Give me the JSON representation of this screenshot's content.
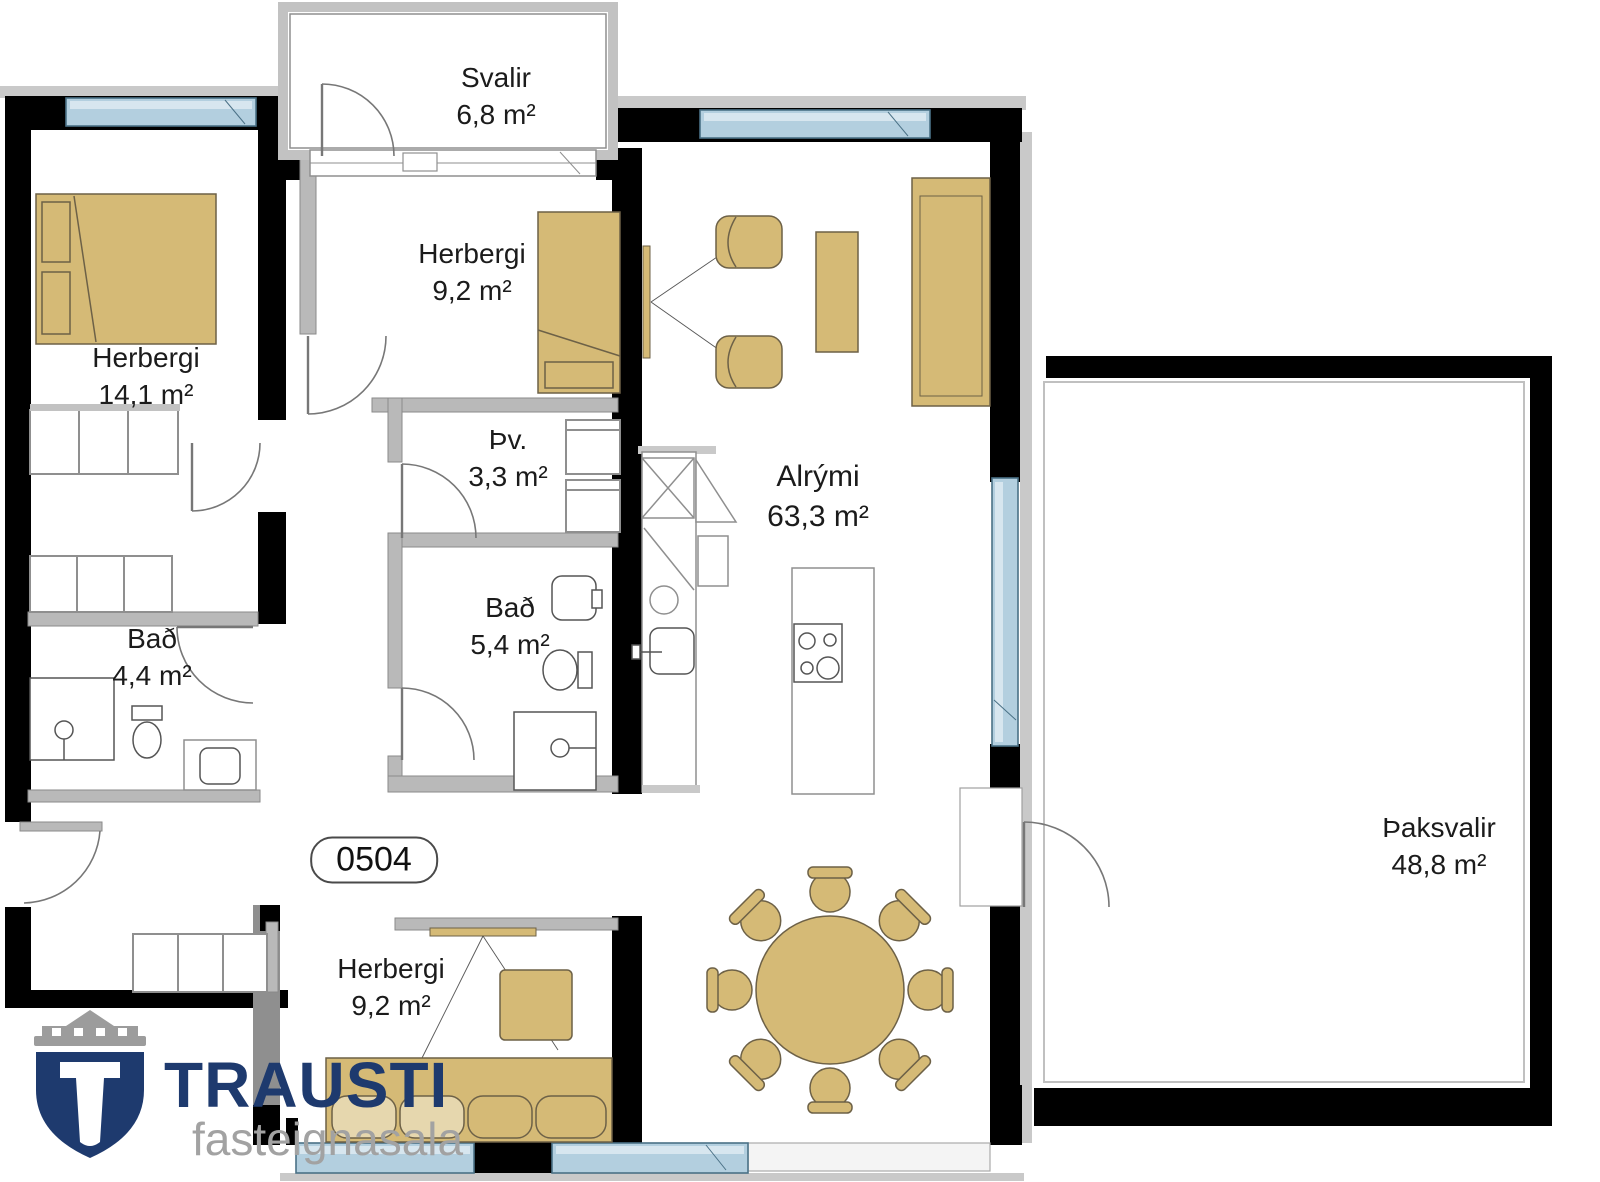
{
  "plan": {
    "unit_number": "0504",
    "rooms": [
      {
        "id": "svalir",
        "name": "Svalir",
        "area": "6,8 m²"
      },
      {
        "id": "herbergi-left",
        "name": "Herbergi",
        "area": "14,1 m²"
      },
      {
        "id": "herbergi-top",
        "name": "Herbergi",
        "area": "9,2 m²"
      },
      {
        "id": "thvottahus",
        "name": "Þv.",
        "area": "3,3 m²"
      },
      {
        "id": "bad-mid",
        "name": "Bað",
        "area": "5,4 m²"
      },
      {
        "id": "bad-left",
        "name": "Bað",
        "area": "4,4 m²"
      },
      {
        "id": "alrymi",
        "name": "Alrými",
        "area": "63,3 m²"
      },
      {
        "id": "herbergi-bottom",
        "name": "Herbergi",
        "area": "9,2 m²"
      },
      {
        "id": "thaksvalir",
        "name": "Þaksvalir",
        "area": "48,8 m²"
      }
    ],
    "logo": {
      "brand": "TRAUSTI",
      "tagline": "fasteignasala"
    },
    "colors": {
      "furniture_tan": "#d5ba76",
      "window_blue": "#b3cfdf",
      "wall_black": "#000000",
      "partition_gray": "#b9b9b9",
      "logo_navy": "#1e3a6e",
      "logo_gray": "#9c9c9c"
    }
  }
}
